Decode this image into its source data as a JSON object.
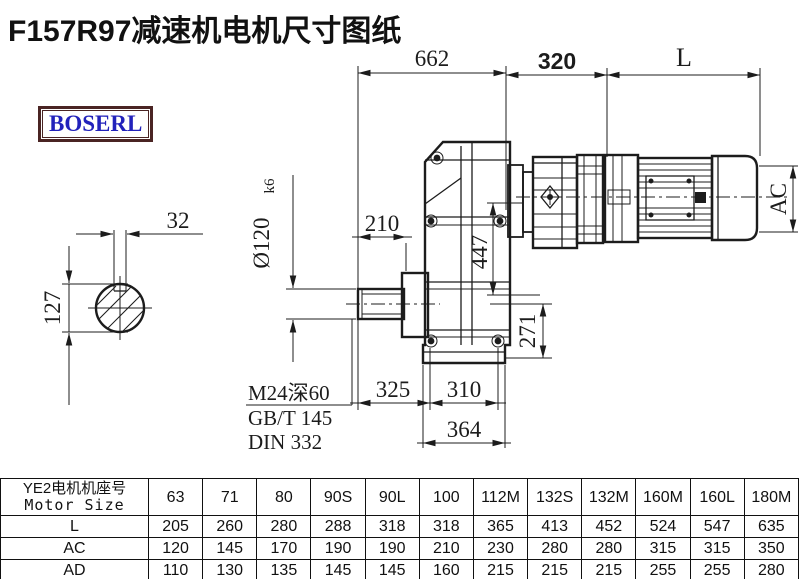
{
  "title": "F157R97减速机电机尺寸图纸",
  "logo": "BOSERL",
  "drawing": {
    "dims": {
      "d662": "662",
      "d320": "320",
      "dL": "L",
      "dAC": "AC",
      "d210": "210",
      "d447": "447",
      "d271": "271",
      "d325": "325",
      "d310": "310",
      "d364": "364",
      "d32": "32",
      "d127": "127",
      "shaft_dia": "Ø120",
      "shaft_tol": "k6"
    },
    "notes": {
      "tap": "M24深60",
      "gb": "GB/T 145",
      "din": "DIN 332"
    }
  },
  "table": {
    "header_cn": "YE2电机机座号",
    "header_en": "Motor Size",
    "columns": [
      "63",
      "71",
      "80",
      "90S",
      "90L",
      "100",
      "112M",
      "132S",
      "132M",
      "160M",
      "160L",
      "180M"
    ],
    "rows": [
      {
        "label": "L",
        "values": [
          "205",
          "260",
          "280",
          "288",
          "318",
          "318",
          "365",
          "413",
          "452",
          "524",
          "547",
          "635"
        ]
      },
      {
        "label": "AC",
        "values": [
          "120",
          "145",
          "170",
          "190",
          "190",
          "210",
          "230",
          "280",
          "280",
          "315",
          "315",
          "350"
        ]
      },
      {
        "label": "AD",
        "values": [
          "110",
          "130",
          "135",
          "145",
          "145",
          "160",
          "215",
          "215",
          "215",
          "255",
          "255",
          "280"
        ]
      }
    ]
  }
}
